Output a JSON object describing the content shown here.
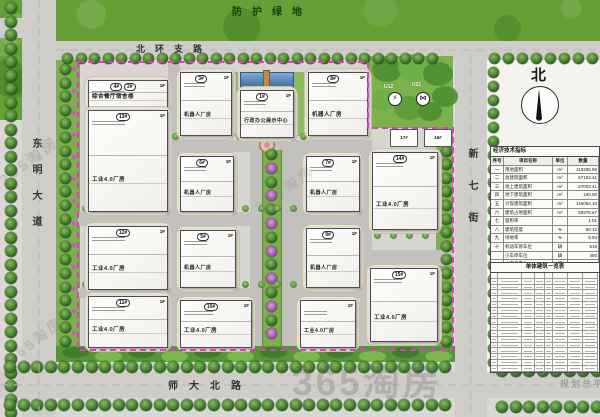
{
  "page": {
    "caption": "规划总平面",
    "watermark": "365淘房"
  },
  "labels": {
    "green_buffer": "防护绿地",
    "north_road": "北环支路",
    "west_road": "东明大道",
    "east_road": "新七街",
    "south_road": "师大北路",
    "compass": "北"
  },
  "park": {
    "symbols": [
      {
        "code": "U12",
        "glyph": "⚡",
        "icon": "power-substation-icon"
      },
      {
        "code": "U21",
        "glyph": "⋈",
        "icon": "utility-station-icon"
      }
    ]
  },
  "buildings": [
    {
      "nums": [
        "4#",
        "2#"
      ],
      "floor": "1F",
      "name": "综合餐厅宿舍楼",
      "x": 88,
      "y": 80,
      "w": 78,
      "h": 26
    },
    {
      "nums": [
        "13#"
      ],
      "floor": "1F",
      "name": "工业4.0厂房",
      "x": 88,
      "y": 110,
      "w": 78,
      "h": 100
    },
    {
      "nums": [
        "3#"
      ],
      "floor": "1F",
      "name": "机器人厂房",
      "x": 180,
      "y": 72,
      "w": 50,
      "h": 62
    },
    {
      "nums": [
        "1#"
      ],
      "floor": "1F",
      "name": "行政办公展示中心",
      "x": 240,
      "y": 90,
      "w": 52,
      "h": 46
    },
    {
      "nums": [
        "8#"
      ],
      "floor": "1F",
      "name": "机器人厂房",
      "x": 308,
      "y": 72,
      "w": 58,
      "h": 62
    },
    {
      "nums": [
        "6#"
      ],
      "floor": "1F",
      "name": "机器人厂房",
      "x": 180,
      "y": 156,
      "w": 52,
      "h": 54
    },
    {
      "nums": [
        "7#"
      ],
      "floor": "1F",
      "name": "机器人厂房",
      "x": 306,
      "y": 156,
      "w": 52,
      "h": 54
    },
    {
      "nums": [
        "14#"
      ],
      "floor": "1F",
      "name": "工业4.0厂房",
      "x": 372,
      "y": 152,
      "w": 64,
      "h": 76
    },
    {
      "nums": [
        "12#"
      ],
      "floor": "1F",
      "name": "工业4.0厂房",
      "x": 88,
      "y": 226,
      "w": 78,
      "h": 62
    },
    {
      "nums": [
        "5#"
      ],
      "floor": "1F",
      "name": "机器人厂房",
      "x": 180,
      "y": 230,
      "w": 54,
      "h": 56
    },
    {
      "nums": [
        "9#"
      ],
      "floor": "1F",
      "name": "机器人厂房",
      "x": 306,
      "y": 228,
      "w": 52,
      "h": 58
    },
    {
      "nums": [
        "11#"
      ],
      "floor": "1F",
      "name": "工业4.0厂房",
      "x": 88,
      "y": 296,
      "w": 78,
      "h": 50
    },
    {
      "nums": [
        "10#"
      ],
      "floor": "1F",
      "name": "工业4.0厂房",
      "x": 180,
      "y": 300,
      "w": 70,
      "h": 46
    },
    {
      "nums": [],
      "floor": "1F",
      "name": "工业4.0厂房",
      "x": 300,
      "y": 300,
      "w": 54,
      "h": 46
    },
    {
      "nums": [
        "15#"
      ],
      "floor": "1F",
      "name": "工业4.0厂房",
      "x": 370,
      "y": 268,
      "w": 66,
      "h": 72
    },
    {
      "nums": [
        "17#"
      ],
      "floor": "",
      "name": "",
      "small": true,
      "x": 390,
      "y": 129,
      "w": 26,
      "h": 16
    },
    {
      "nums": [
        "16#"
      ],
      "floor": "",
      "name": "",
      "small": true,
      "x": 424,
      "y": 129,
      "w": 26,
      "h": 16
    }
  ],
  "indicators_table": {
    "title": "经济技术指标",
    "headers": [
      "序号",
      "项目名称",
      "单位",
      "数量"
    ],
    "rows": [
      [
        "一",
        "用地面积",
        "m²",
        "118255.98"
      ],
      [
        "二",
        "总建筑面积",
        "m²",
        "67153.41"
      ],
      [
        "三",
        "地上建筑面积",
        "m²",
        "67003.41"
      ],
      [
        "四",
        "地下建筑面积",
        "m²",
        "150.00"
      ],
      [
        "五",
        "计容建筑面积",
        "m²",
        "118064.10"
      ],
      [
        "六",
        "建筑占地面积",
        "m²",
        "59378.67"
      ],
      [
        "七",
        "容积率",
        "",
        "1.01"
      ],
      [
        "八",
        "建筑密度",
        "%",
        "50.12"
      ],
      [
        "九",
        "绿地率",
        "%",
        "5.94"
      ],
      [
        "十",
        "机动车停车位",
        "辆",
        "518"
      ],
      [
        "",
        "小车停车位",
        "辆",
        "480"
      ],
      [
        "",
        "大车停车位",
        "辆",
        "38"
      ]
    ]
  },
  "schedule_table": {
    "title": "单体建筑一览表",
    "rows": 17,
    "cols": 8
  }
}
